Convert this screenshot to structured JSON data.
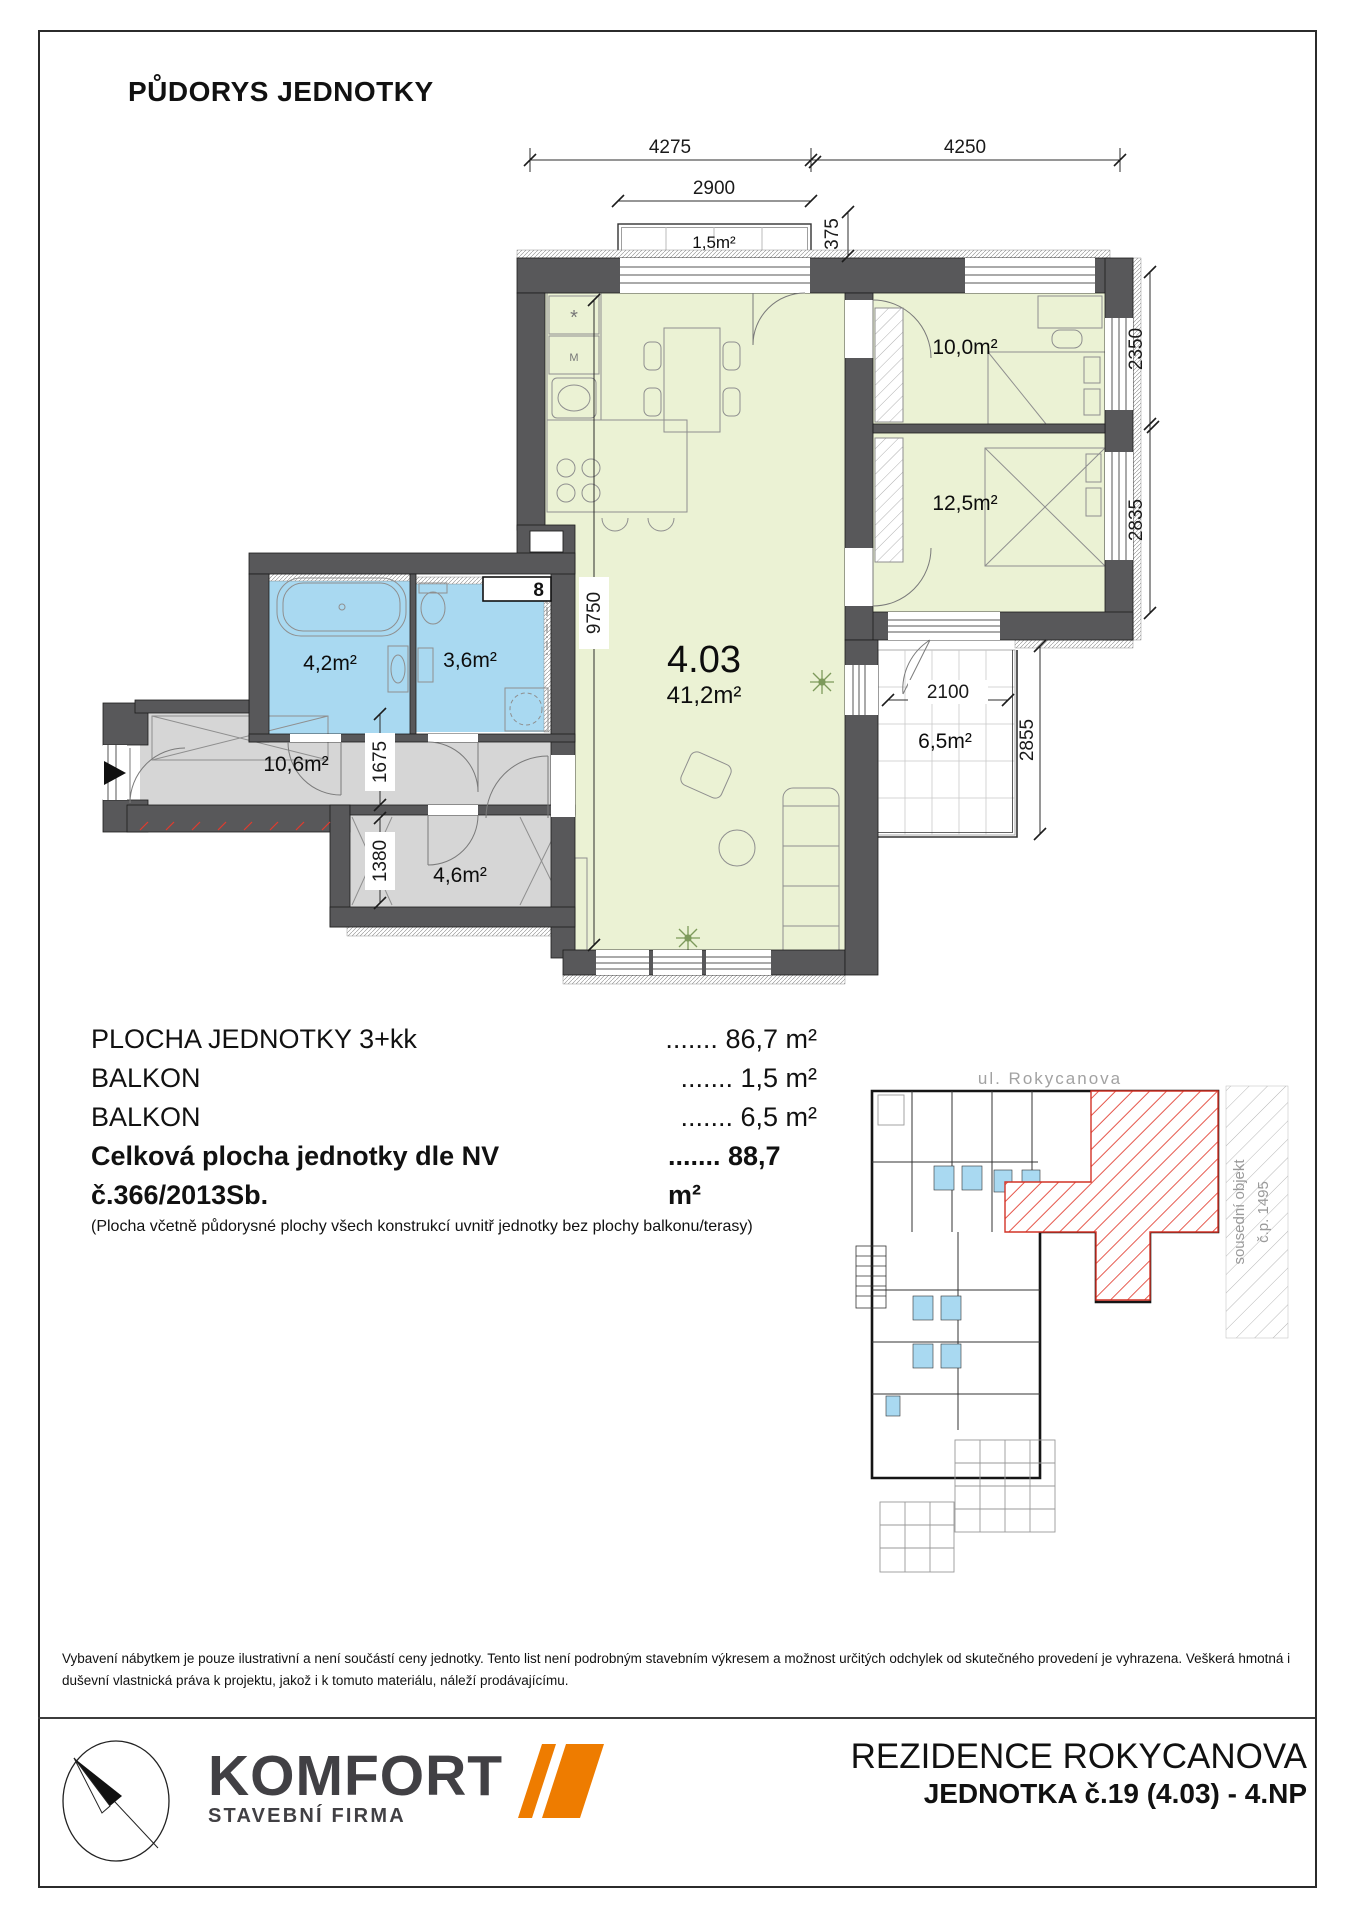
{
  "sheet": {
    "title": "PŮDORYS JEDNOTKY",
    "disclaimer": "Vybavení nábytkem je pouze ilustrativní a není součástí ceny jednotky. Tento list není podrobným stavebním výkresem a možnost určitých odchylek od skutečného provedení je vyhrazena. Veškerá hmotná i duševní vlastnická práva k projektu, jakož i k tomuto materiálu, náleží prodávajícímu."
  },
  "plan": {
    "unit_number": "4.03",
    "unit_area": "41,2m²",
    "room_labels": {
      "balcony_top": "1,5m²",
      "bedroom1": "10,0m²",
      "bedroom2": "12,5m²",
      "bathroom": "4,2m²",
      "wc": "3,6m²",
      "hallway": "10,6m²",
      "closet": "4,6m²",
      "balcony_side": "6,5m²",
      "shaft": "8",
      "fridge_mark": "*",
      "micro_mark": "M"
    },
    "dimensions": {
      "top_left": "4275",
      "top_right": "4250",
      "balcony_top_width": "2900",
      "wall_offset": "375",
      "right_upper": "2350",
      "right_lower": "2835",
      "living_height": "9750",
      "hallway_width": "1675",
      "closet_width": "1380",
      "balcony_side_width": "2100",
      "balcony_side_height": "2855"
    }
  },
  "areas": {
    "rows": [
      {
        "label": "PLOCHA JEDNOTKY 3+kk",
        "dots": ".......",
        "value": "86,7 m²"
      },
      {
        "label": "BALKON",
        "dots": ".......",
        "value": "1,5 m²"
      },
      {
        "label": "BALKON",
        "dots": ".......",
        "value": "6,5 m²"
      },
      {
        "label": "Celková plocha jednotky dle NV č.366/2013Sb.",
        "dots": ".......",
        "value": "88,7 m²"
      }
    ],
    "note": "(Plocha včetně půdorysné plochy všech konstrukcí uvnitř jednotky bez plochy balkonu/terasy)"
  },
  "siteplan": {
    "street": "ul. Rokycanova",
    "neighbor_line1": "sousední objekt",
    "neighbor_line2": "č.p. 1495"
  },
  "footer": {
    "brand": "KOMFORT",
    "brand_subtitle": "STAVEBNÍ FIRMA",
    "project": "REZIDENCE ROKYCANOVA",
    "unit": "JEDNOTKA č.19 (4.03) - 4.NP"
  },
  "colors": {
    "wall": "#58585a",
    "room_green": "#ebf2d4",
    "room_blue": "#a9d9f1",
    "room_gray": "#d6d6d6",
    "accent_orange": "#ee7c00",
    "highlight_red": "#e03a2f"
  }
}
